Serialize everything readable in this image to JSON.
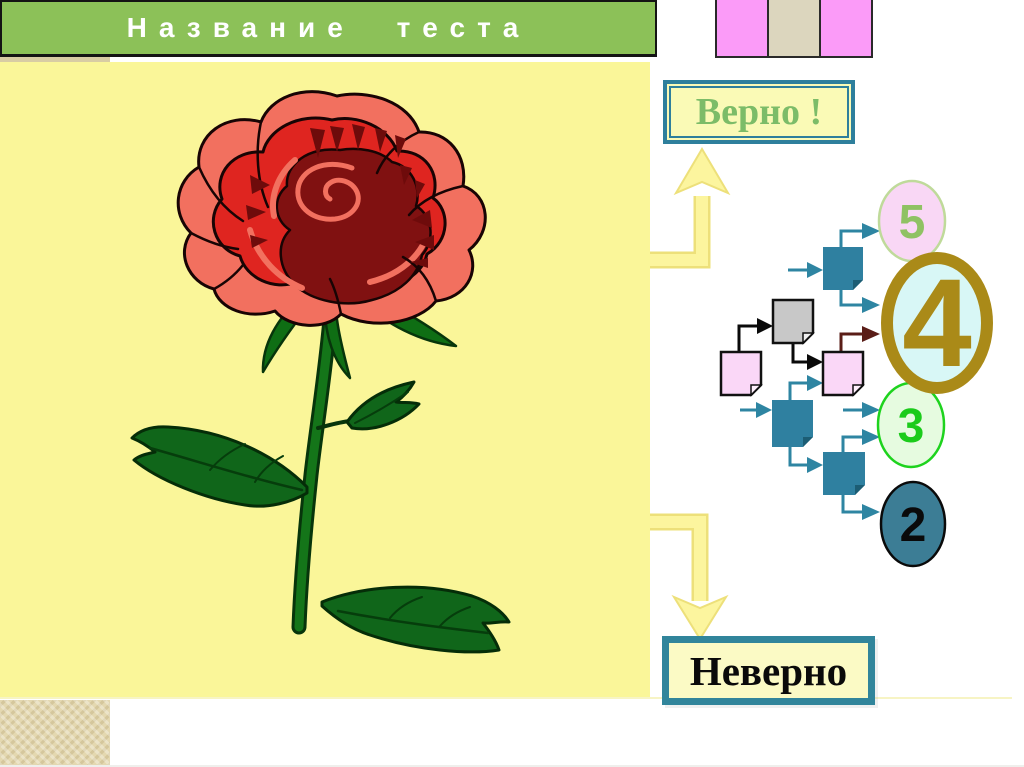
{
  "slide": {
    "title": "Название теста",
    "answer_buttons": {
      "correct": "Верно !",
      "incorrect": "Неверно"
    },
    "image": "red-rose-clipart",
    "score_circles": [
      {
        "label": "5"
      },
      {
        "label": "4"
      },
      {
        "label": "3"
      },
      {
        "label": "2"
      }
    ],
    "colors": {
      "header_green": "#8CC158",
      "panel_yellow": "#FAF699",
      "teal_accent": "#31859B",
      "gold_accent": "#AA8A18",
      "maroon_arrow": "#5A1D17",
      "deco_pink": "#FB9BF8",
      "deco_beige": "#DCD6BE",
      "tan": "#E4D8B0",
      "arrow_yellow": "#FCF59E",
      "correct_text_green": "#7CBC68",
      "circle5_fill": "#F9D7F5",
      "circle4_fill": "#D8F7F6",
      "circle3_fill": "#E6FBE0",
      "circle2_fill": "#3C7D95"
    }
  }
}
